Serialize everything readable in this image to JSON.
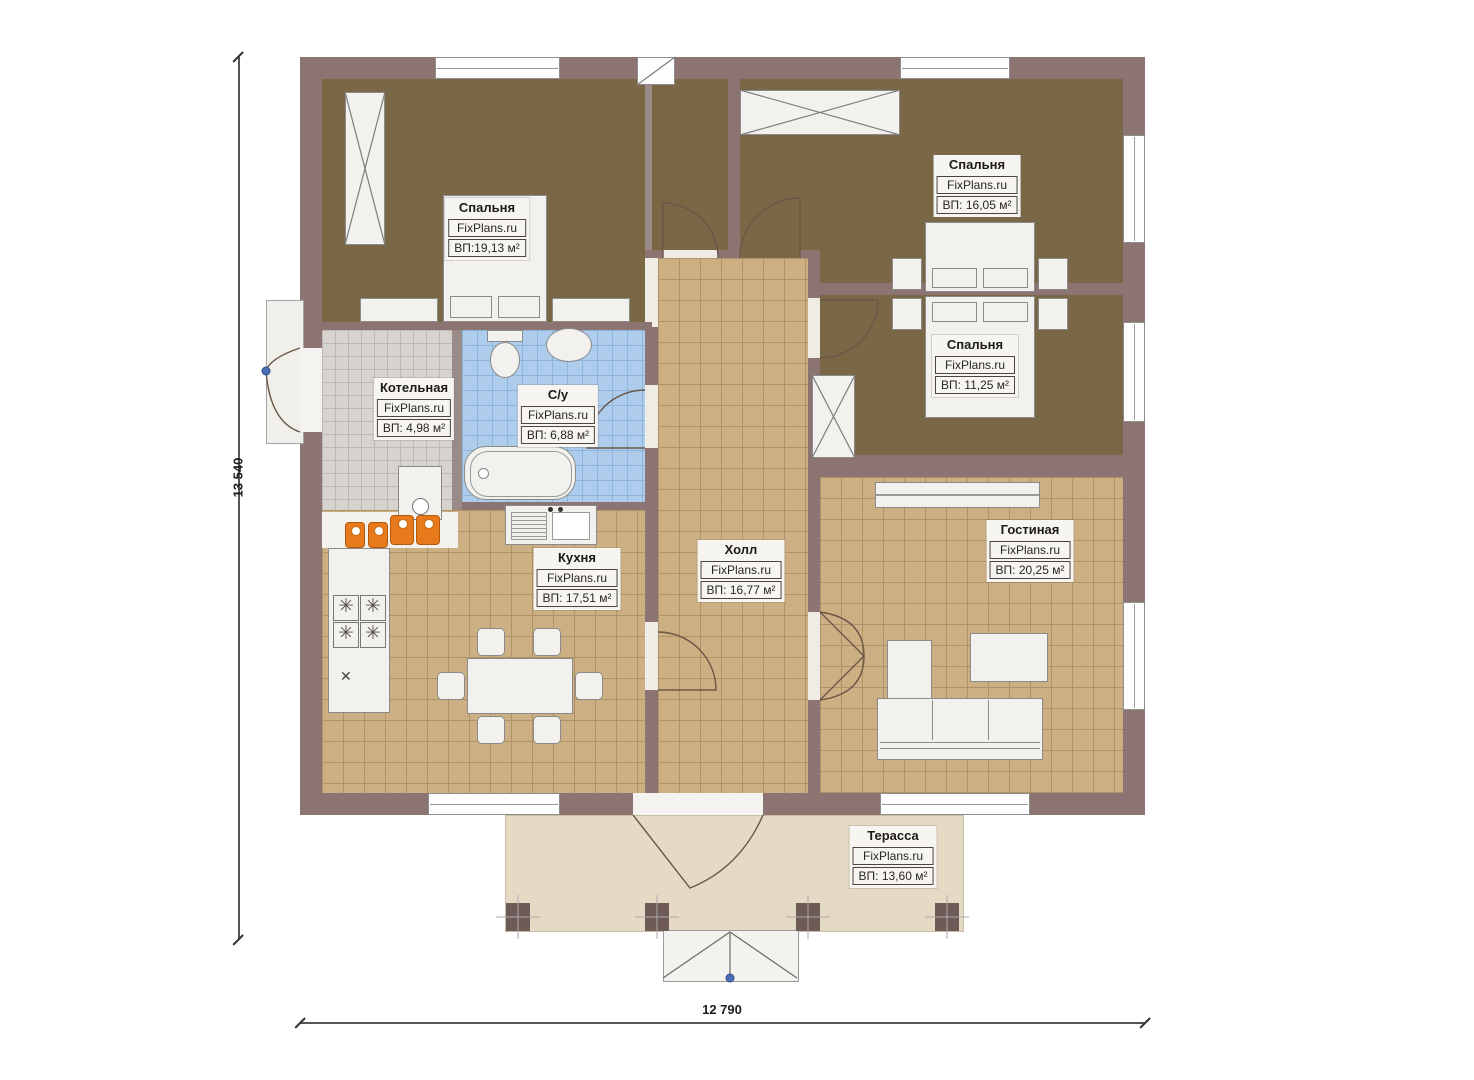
{
  "plan": {
    "title": "Одноэтажный дом — план",
    "brand": "FixPlans.ru",
    "dimensions": {
      "height": "13 540",
      "width": "12 790"
    },
    "rooms": [
      {
        "id": "bedroom-1",
        "name": "Спальня",
        "area": "ВП:19,13 м²"
      },
      {
        "id": "bedroom-2",
        "name": "Спальня",
        "area": "ВП: 16,05 м²"
      },
      {
        "id": "bedroom-3",
        "name": "Спальня",
        "area": "ВП: 11,25 м²"
      },
      {
        "id": "boiler-room",
        "name": "Котельная",
        "area": "ВП: 4,98 м²"
      },
      {
        "id": "bathroom",
        "name": "С/у",
        "area": "ВП: 6,88 м²"
      },
      {
        "id": "kitchen",
        "name": "Кухня",
        "area": "ВП: 17,51 м²"
      },
      {
        "id": "hall",
        "name": "Холл",
        "area": "ВП: 16,77 м²"
      },
      {
        "id": "living-room",
        "name": "Гостиная",
        "area": "ВП: 20,25 м²"
      },
      {
        "id": "terrace",
        "name": "Терасса",
        "area": "ВП: 13,60 м²"
      }
    ],
    "colors": {
      "wall": "#8b7472",
      "bedroom_floor": "#7a6746",
      "tile_tan": "#ccb083",
      "tile_blue": "#aecdec",
      "tile_gray": "#d7d4d0",
      "terrace": "#e5dbc5",
      "equipment_orange": "#e87a1e",
      "marker_blue": "#4a6fb5"
    }
  }
}
